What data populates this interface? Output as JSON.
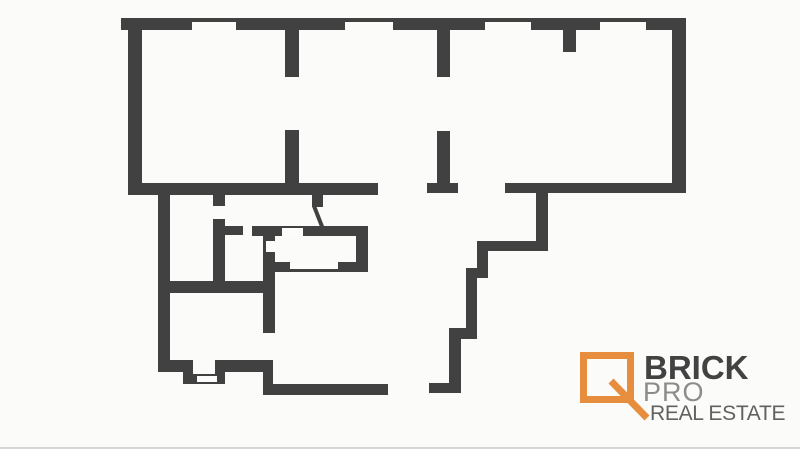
{
  "canvas": {
    "width": 800,
    "height": 449,
    "background": "#fbfbfa",
    "bottom_border_color": "#d6d6d6"
  },
  "floorplan": {
    "wall_color": "#414141",
    "opening_color": "#fcfcfb",
    "walls": [
      {
        "name": "top-wall",
        "x": 121,
        "y": 18,
        "w": 565,
        "h": 12
      },
      {
        "name": "left-wall",
        "x": 128,
        "y": 18,
        "w": 14,
        "h": 177
      },
      {
        "name": "right-wall",
        "x": 672,
        "y": 18,
        "w": 14,
        "h": 175
      },
      {
        "name": "mid-bottom-wall-left",
        "x": 128,
        "y": 183,
        "w": 250,
        "h": 12
      },
      {
        "name": "mid-wall-foot",
        "x": 427,
        "y": 183,
        "w": 31,
        "h": 10
      },
      {
        "name": "mid-bottom-wall-right",
        "x": 505,
        "y": 183,
        "w": 181,
        "h": 10
      },
      {
        "name": "interior-wall-1-upper",
        "x": 285,
        "y": 30,
        "w": 14,
        "h": 47
      },
      {
        "name": "interior-wall-1-lower",
        "x": 285,
        "y": 130,
        "w": 14,
        "h": 53
      },
      {
        "name": "interior-wall-2-upper",
        "x": 437,
        "y": 30,
        "w": 13,
        "h": 47
      },
      {
        "name": "interior-wall-2-lower",
        "x": 437,
        "y": 131,
        "w": 13,
        "h": 52
      },
      {
        "name": "top-wall-stub",
        "x": 563,
        "y": 30,
        "w": 13,
        "h": 22
      },
      {
        "name": "lower-left-wall",
        "x": 158,
        "y": 195,
        "w": 12,
        "h": 177
      },
      {
        "name": "lower-left-stub",
        "x": 213,
        "y": 195,
        "w": 12,
        "h": 11
      },
      {
        "name": "lower-mid-wall",
        "x": 213,
        "y": 219,
        "w": 12,
        "h": 69
      },
      {
        "name": "lower-mid-stub-right",
        "x": 225,
        "y": 226,
        "w": 18,
        "h": 9
      },
      {
        "name": "lower-horizontal-wall",
        "x": 158,
        "y": 281,
        "w": 117,
        "h": 12
      },
      {
        "name": "stair-box-top",
        "x": 252,
        "y": 226,
        "w": 116,
        "h": 10
      },
      {
        "name": "stair-box-left-long",
        "x": 263,
        "y": 226,
        "w": 12,
        "h": 107
      },
      {
        "name": "stair-box-right",
        "x": 356,
        "y": 226,
        "w": 12,
        "h": 46
      },
      {
        "name": "stair-box-bottom",
        "x": 273,
        "y": 262,
        "w": 95,
        "h": 10
      },
      {
        "name": "door-stub",
        "x": 312,
        "y": 195,
        "w": 11,
        "h": 12
      },
      {
        "name": "step-left-h1",
        "x": 158,
        "y": 360,
        "w": 35,
        "h": 12
      },
      {
        "name": "step-left-v1",
        "x": 183,
        "y": 360,
        "w": 10,
        "h": 23
      },
      {
        "name": "step-left-h2",
        "x": 183,
        "y": 374,
        "w": 42,
        "h": 10
      },
      {
        "name": "step-left-v2",
        "x": 215,
        "y": 360,
        "w": 10,
        "h": 24
      },
      {
        "name": "step-left-h3",
        "x": 215,
        "y": 360,
        "w": 58,
        "h": 12
      },
      {
        "name": "step-left-v3",
        "x": 263,
        "y": 360,
        "w": 10,
        "h": 35
      },
      {
        "name": "bottom-long-wall",
        "x": 263,
        "y": 384,
        "w": 125,
        "h": 11
      },
      {
        "name": "bottom-right-wall",
        "x": 429,
        "y": 383,
        "w": 32,
        "h": 10
      },
      {
        "name": "zigzag-v1",
        "x": 536,
        "y": 193,
        "w": 12,
        "h": 58
      },
      {
        "name": "zigzag-h1",
        "x": 477,
        "y": 241,
        "w": 71,
        "h": 10
      },
      {
        "name": "zigzag-v2",
        "x": 477,
        "y": 241,
        "w": 11,
        "h": 37
      },
      {
        "name": "zigzag-h2",
        "x": 466,
        "y": 268,
        "w": 22,
        "h": 10
      },
      {
        "name": "zigzag-v3",
        "x": 466,
        "y": 268,
        "w": 11,
        "h": 71
      },
      {
        "name": "zigzag-h3",
        "x": 449,
        "y": 328,
        "w": 28,
        "h": 11
      },
      {
        "name": "zigzag-v4",
        "x": 449,
        "y": 328,
        "w": 12,
        "h": 64
      }
    ],
    "openings": [
      {
        "name": "window-top-1",
        "x": 192,
        "y": 22,
        "w": 44,
        "h": 8
      },
      {
        "name": "window-top-2",
        "x": 345,
        "y": 22,
        "w": 48,
        "h": 8
      },
      {
        "name": "window-top-3",
        "x": 485,
        "y": 22,
        "w": 46,
        "h": 8
      },
      {
        "name": "window-top-4",
        "x": 600,
        "y": 22,
        "w": 46,
        "h": 8
      },
      {
        "name": "stair-box-top-opening",
        "x": 282,
        "y": 228,
        "w": 21,
        "h": 8
      },
      {
        "name": "stair-box-left-opening",
        "x": 266,
        "y": 241,
        "w": 9,
        "h": 11
      },
      {
        "name": "stair-box-bottom-opening",
        "x": 290,
        "y": 262,
        "w": 48,
        "h": 7
      },
      {
        "name": "step-door-opening",
        "x": 197,
        "y": 376,
        "w": 20,
        "h": 6
      }
    ],
    "door_swing": {
      "x1": 314,
      "y1": 206,
      "x2": 323,
      "y2": 229,
      "width": 4
    }
  },
  "logo": {
    "brand": "BRICK",
    "brand_color": "#424242",
    "sub": "PRO",
    "sub_color": "#8c8c8c",
    "tagline": "REAL ESTATE",
    "tagline_color": "#616161",
    "accent": "#e78e3e",
    "handle": {
      "x1": 611,
      "y1": 381,
      "x2": 647,
      "y2": 418,
      "width": 7
    }
  }
}
